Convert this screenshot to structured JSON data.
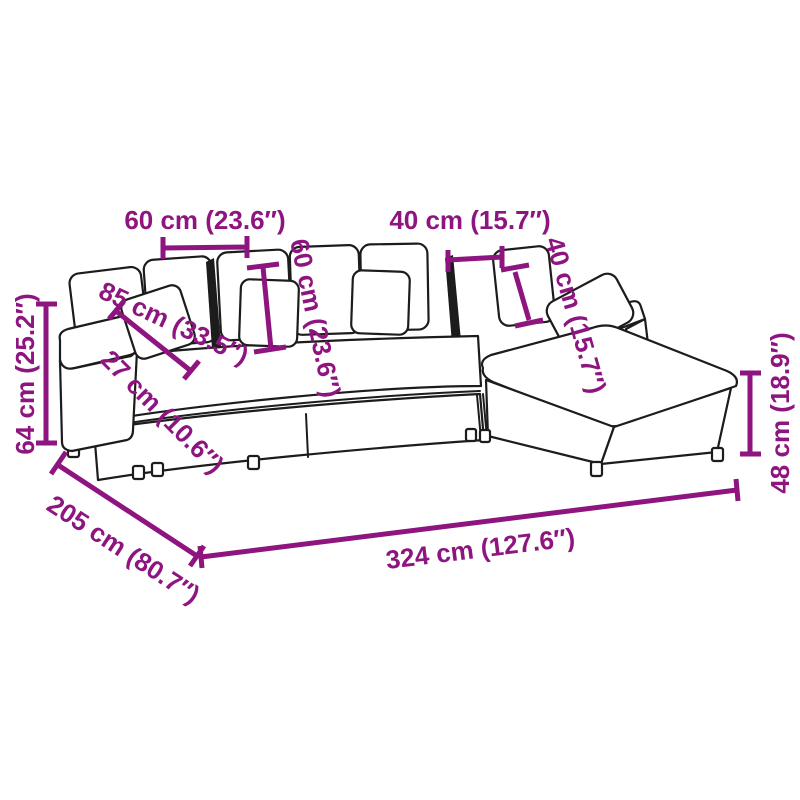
{
  "diagram": {
    "kind": "product-dimension-diagram",
    "subject": "modular-l-shaped-sofa-with-ottoman",
    "background_color": "#FFFFFF",
    "outline_color": "#1C1C1C",
    "accent_color": "#8E157F"
  },
  "dimensions": [
    {
      "id": "module-seat-width-left",
      "label": "60 cm (23.6″)",
      "cm": 60,
      "inches": 23.6,
      "orientation": "horizontal"
    },
    {
      "id": "backrest-height-left",
      "label": "60 cm (23.6″)",
      "cm": 60,
      "inches": 23.6,
      "orientation": "vertical-tilted"
    },
    {
      "id": "module-seat-width-right",
      "label": "40 cm (15.7″)",
      "cm": 40,
      "inches": 15.7,
      "orientation": "horizontal"
    },
    {
      "id": "backrest-height-right",
      "label": "40 cm (15.7″)",
      "cm": 40,
      "inches": 15.7,
      "orientation": "vertical-tilted"
    },
    {
      "id": "seat-depth",
      "label": "85 cm (33.5″)",
      "cm": 85,
      "inches": 33.5,
      "orientation": "diagonal"
    },
    {
      "id": "armrest-width",
      "label": "27 cm (10.6″)",
      "cm": 27,
      "inches": 10.6,
      "orientation": "diagonal"
    },
    {
      "id": "overall-height",
      "label": "64 cm (25.2″)",
      "cm": 64,
      "inches": 25.2,
      "orientation": "vertical"
    },
    {
      "id": "seat-height",
      "label": "48 cm (18.9″)",
      "cm": 48,
      "inches": 18.9,
      "orientation": "vertical"
    },
    {
      "id": "overall-depth",
      "label": "205 cm (80.7″)",
      "cm": 205,
      "inches": 80.7,
      "orientation": "diagonal"
    },
    {
      "id": "overall-width",
      "label": "324 cm (127.6″)",
      "cm": 324,
      "inches": 127.6,
      "orientation": "horizontal-tilted"
    }
  ]
}
